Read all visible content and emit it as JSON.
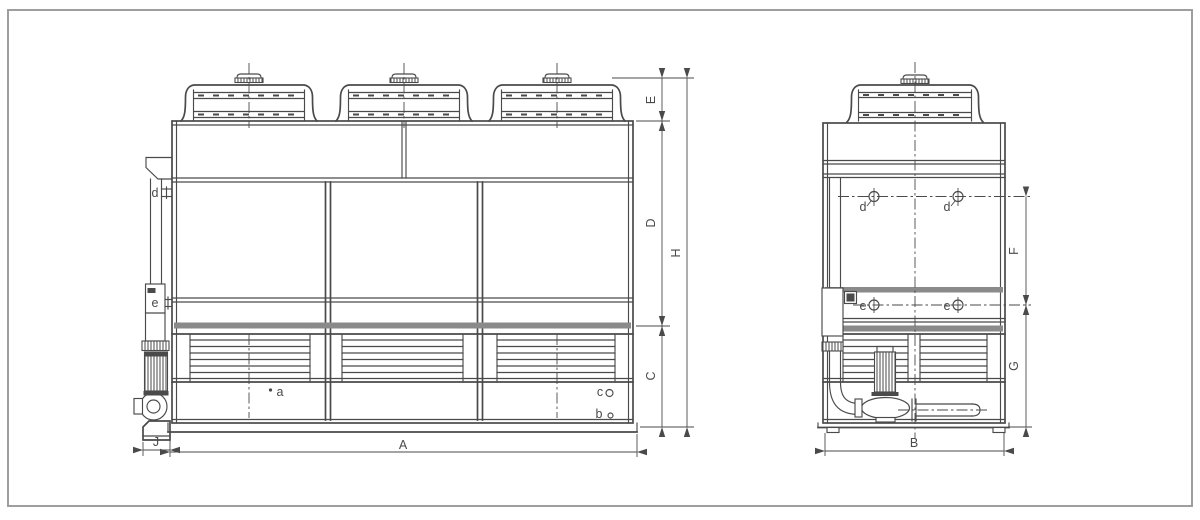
{
  "drawing": {
    "kind": "two-view dimensional outline drawing",
    "views": {
      "front": {
        "fan_count": 3,
        "dimension_labels": [
          "E",
          "D",
          "H",
          "C",
          "A",
          "J"
        ],
        "connection_labels": [
          "d",
          "e",
          "a",
          "c",
          "b"
        ]
      },
      "side": {
        "fan_count": 1,
        "dimension_labels": [
          "F",
          "G",
          "B"
        ],
        "connection_labels": [
          "d",
          "d",
          "e",
          "e"
        ]
      }
    }
  },
  "labels": {
    "A": "A",
    "B": "B",
    "C": "C",
    "D": "D",
    "E": "E",
    "F": "F",
    "G": "G",
    "H": "H",
    "J": "J",
    "a": "a",
    "b": "b",
    "c": "c",
    "d": "d",
    "e": "e"
  },
  "colors": {
    "line": "#4a4a4a",
    "band": "#8a8a8a",
    "frame": "#9e9e9e",
    "bg": "#ffffff"
  }
}
